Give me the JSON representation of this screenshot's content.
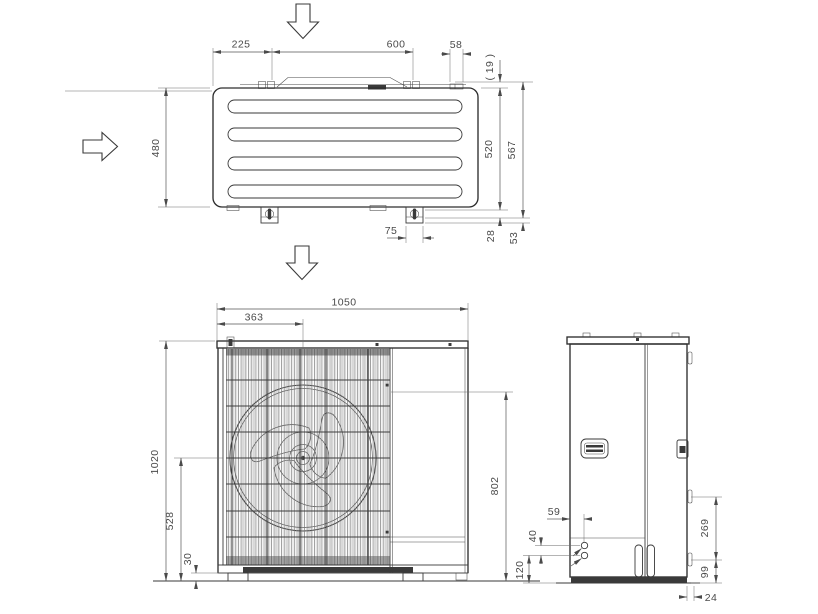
{
  "drawing": {
    "background": "#ffffff",
    "line_color": "#3a3a3a",
    "dim_color": "#4a4a4a",
    "icons": {
      "airflow_top": "arrow-down-icon",
      "airflow_left": "arrow-right-icon",
      "airflow_bottom": "arrow-down-icon"
    },
    "views": {
      "top": {
        "dims": {
          "left_offset": "225",
          "bracket_pitch": "600",
          "bracket_width": "58",
          "bracket_gap": "( 19 )",
          "depth": "480",
          "depth_to_plate": "520",
          "overall_depth": "567",
          "foot_width": "75",
          "plate_step": "28",
          "foot_step": "53"
        }
      },
      "front": {
        "dims": {
          "width": "1050",
          "fan_center_x": "363",
          "height": "1020",
          "fan_center_y": "528",
          "base_height": "30",
          "pipe_height": "802"
        }
      },
      "side": {
        "dims": {
          "pipe_offset_x": "59",
          "pipe_gap": "40",
          "pipe_offset_y": "120",
          "valve_span": "269",
          "valve_height": "99",
          "base_offset": "24"
        }
      }
    }
  }
}
